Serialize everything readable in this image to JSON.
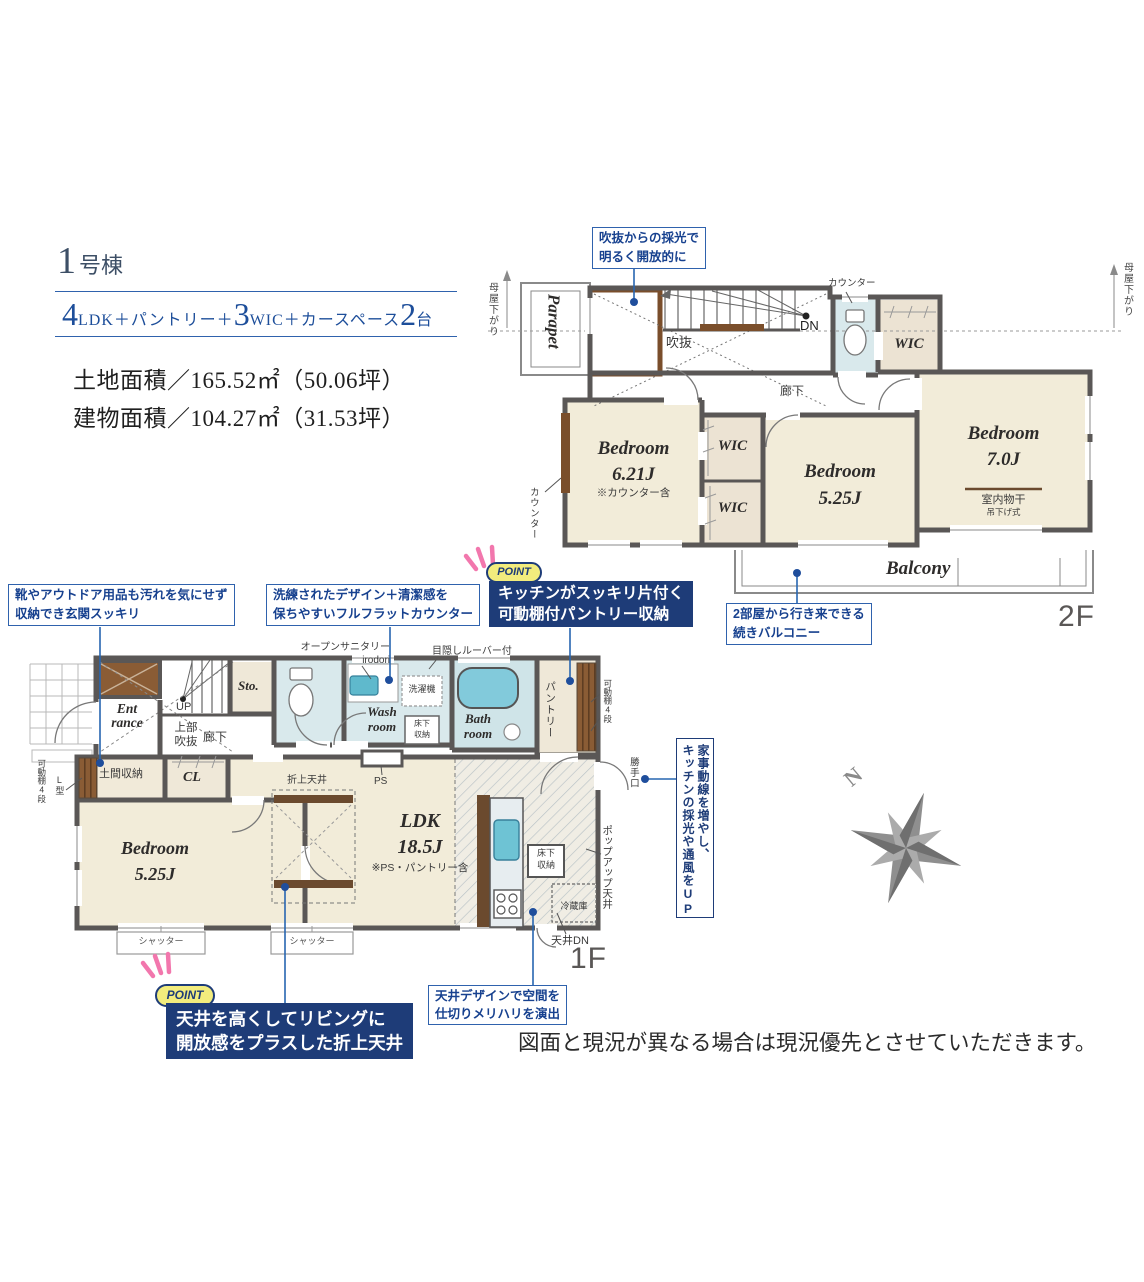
{
  "header": {
    "lot_num": "1",
    "lot_suffix": "号棟",
    "spec": [
      {
        "n": "4",
        "t": "LDK＋パントリー＋"
      },
      {
        "n": "3",
        "t": "WIC＋カースペース"
      },
      {
        "n": "2",
        "t": "台"
      }
    ],
    "land_area": "土地面積／165.52㎡（50.06坪）",
    "building_area": "建物面積／104.27㎡（31.53坪）"
  },
  "floor2": {
    "floor_label": "2F",
    "parapet": "Parapet",
    "void_label": "吹抜",
    "dn": "DN",
    "corridor": "廊下",
    "counter_top": "カウンター",
    "counter_left": "カウンター",
    "moya_left": "母屋下がり",
    "moya_right": "母屋下がり",
    "wic_top": "WIC",
    "wic_a": "WIC",
    "wic_b": "WIC",
    "bedroom1_name": "Bedroom",
    "bedroom1_size": "6.21J",
    "bedroom1_note": "※カウンター含",
    "bedroom2_name": "Bedroom",
    "bedroom2_size": "5.25J",
    "bedroom3_name": "Bedroom",
    "bedroom3_size": "7.0J",
    "laundry1": "室内物干",
    "laundry2": "吊下げ式",
    "balcony": "Balcony",
    "callout_void1": "吹抜からの採光で",
    "callout_void2": "明るく開放的に",
    "callout_balcony1": "2部屋から行き来できる",
    "callout_balcony2": "続きバルコニー"
  },
  "floor1": {
    "floor_label": "1F",
    "entrance1": "Ent",
    "entrance2": "rance",
    "up": "UP",
    "upper_void1": "上部",
    "upper_void2": "吹抜",
    "corridor": "廊下",
    "sto": "Sto.",
    "open_sanitary1": "オープンサニタリー",
    "open_sanitary2": "irodori",
    "louver": "目隠しルーバー付",
    "washer": "洗濯機",
    "washroom1": "Wash",
    "washroom2": "room",
    "underfloor_a1": "床下",
    "underfloor_a2": "収納",
    "bathroom1": "Bath",
    "bathroom2": "room",
    "pantry": "パントリー",
    "shelf_right": "可動棚4段",
    "backdoor": "勝手口",
    "ps": "PS",
    "doma": "土間収納",
    "shelf_left": "可動棚4段",
    "l_type": "L型",
    "cl": "CL",
    "bedroom_name": "Bedroom",
    "bedroom_size": "5.25J",
    "ldk_name": "LDK",
    "ldk_size": "18.5J",
    "ldk_note": "※PS・パントリー含",
    "orage": "折上天井",
    "underfloor_b1": "床下",
    "underfloor_b2": "収納",
    "fridge": "冷蔵庫",
    "popup": "ポップアップ天井",
    "ceiling_dn": "天井DN",
    "shutter1": "シャッター",
    "shutter2": "シャッター"
  },
  "callouts": {
    "entrance1": "靴やアウトドア用品も汚れを気にせず",
    "entrance2": "収納でき玄関スッキリ",
    "counter1": "洗練されたデザイン＋清潔感を",
    "counter2": "保ちやすいフルフラットカウンター",
    "kaji1": "家事動線を増やし、",
    "kaji2": "キッチンの採光や通風をUP",
    "ceiling1": "天井デザインで空間を",
    "ceiling2": "仕切りメリハリを演出"
  },
  "points": {
    "badge": "POINT",
    "pantry1": "キッチンがスッキリ片付く",
    "pantry2": "可動棚付パントリー収納",
    "ceiling1": "天井を高くしてリビングに",
    "ceiling2": "開放感をプラスした折上天井"
  },
  "compass": {
    "north": "N"
  },
  "disclaimer": "図面と現況が異なる場合は現況優先とさせていただきます。",
  "colors": {
    "navy": "#1e3c78",
    "callout_blue": "#2f62ad",
    "point_yellow": "#f2ec7d",
    "ray_pink": "#f277ad",
    "room_cream": "#f2ecd9",
    "wic_taupe": "#ece3d3",
    "wet_blue": "#d9e9ec",
    "tub_cyan": "#82cadb",
    "wall_gray": "#5a5756",
    "wood_brown": "#7a4e2b",
    "compass_gray": "#8f8f8f"
  }
}
